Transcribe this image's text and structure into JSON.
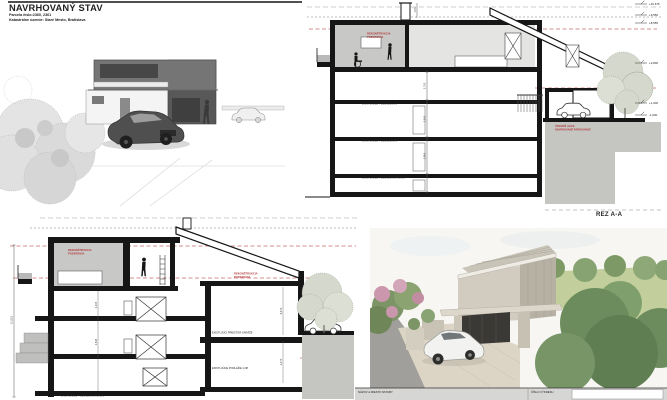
{
  "header": {
    "title": "NAVRHOVANÝ STAV",
    "parcel": "Parcela číslo:2360, 2361",
    "cadastre": "Katastrálne územie: Staré Mesto, Bratislava"
  },
  "labels": {
    "recon1": "REKONŠTRUKCIA",
    "recon2": "PODKROVIA",
    "street1": "ÚROVEŇ ULICE",
    "street2": "NAVRHOVANÉ PARKOVANIE"
  },
  "floors": {
    "f2": "EXISTUJÚCE PODLAŽIE 2.NP",
    "f1": "EXISTUJÚCE PODLAŽIE 1.NP",
    "bas": "EXISTUJÚCE PODLAŽIE SUTERÉN",
    "garage": "EXISTUJÚCI PRIESTOR GARÁŽE",
    "garage_floor": "EXISTUJÚCE PODLAŽIE 1.NP"
  },
  "section_a": {
    "name": "REZ A-A",
    "elevations": [
      "+10,675",
      "+9,550",
      "+8,555",
      "+3,800",
      "+1,000",
      "-1,000"
    ],
    "dims": [
      "1,05",
      "2,700",
      "2,500",
      "2,800"
    ]
  },
  "section_b": {
    "dims": [
      "11,015",
      "3,105",
      "2,645",
      "6,475",
      "2,475"
    ]
  },
  "footer": {
    "project_label": "NÁZOV A MIESTO STAVBY",
    "number_label": "ČÍSLO VÝKRESU"
  },
  "colors": {
    "annotation_red": "#b23b3b",
    "guide_red": "#c96b6b",
    "ink_black": "#161616",
    "poche_gray": "#c8c8c6"
  }
}
